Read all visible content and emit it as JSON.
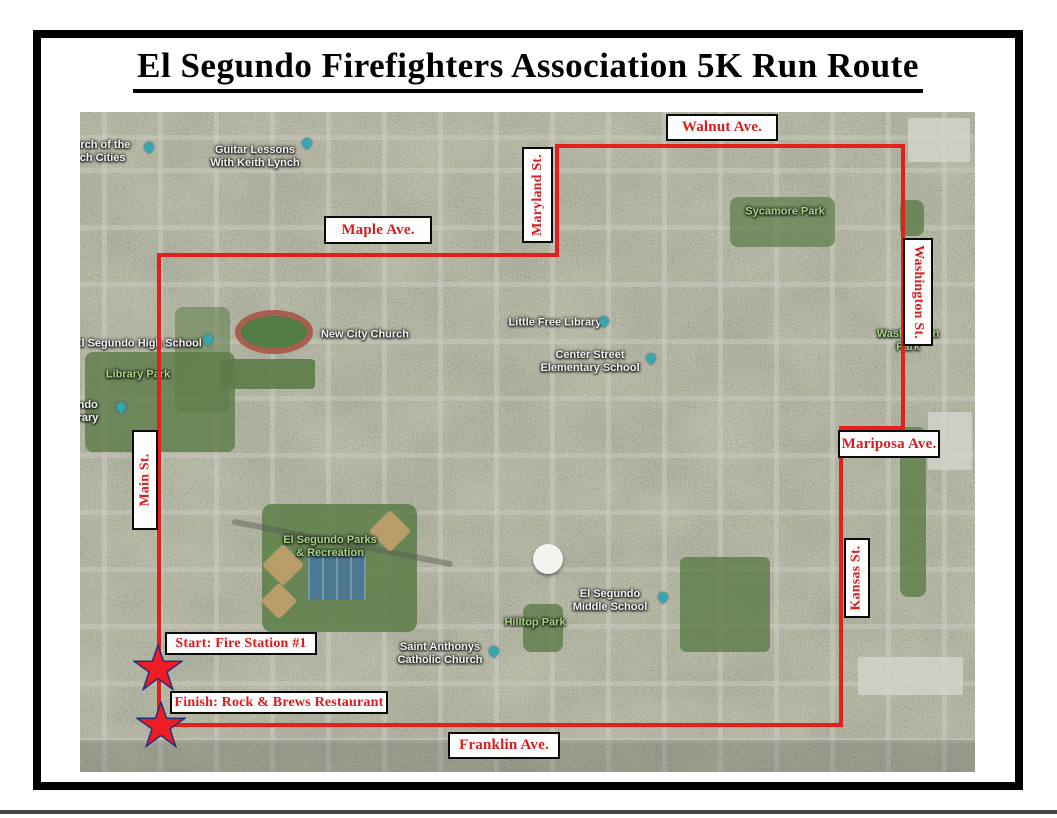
{
  "title": "El Segundo Firefighters Association 5K Run Route",
  "streets": {
    "walnut": "Walnut Ave.",
    "maple": "Maple Ave.",
    "maryland": "Maryland St.",
    "washington": "Washington St.",
    "mariposa": "Mariposa Ave.",
    "main": "Main St.",
    "kansas": "Kansas St.",
    "franklin": "Franklin Ave."
  },
  "markers": {
    "start": "Start: Fire Station #1",
    "finish": "Finish: Rock & Brews Restaurant"
  },
  "map_pois": {
    "church_beach_cities": {
      "line1": "urch of the",
      "line2": "ach Cities"
    },
    "guitar_lessons": {
      "line1": "Guitar Lessons",
      "line2": "With Keith Lynch"
    },
    "sycamore_park": "Sycamore Park",
    "high_school": "El Segundo High School",
    "library_park": "Library Park",
    "library_clipped": {
      "line1": "ndo",
      "line2": "rary"
    },
    "new_city_church": "New City Church",
    "little_free_library": "Little Free Library",
    "center_street_school": {
      "line1": "Center Street",
      "line2": "Elementary School"
    },
    "washington_park": {
      "line1": "Washington",
      "line2": "Park"
    },
    "parks_recreation": {
      "line1": "El Segundo Parks",
      "line2": "& Recreation"
    },
    "hilltop_park": "Hilltop Park",
    "middle_school": {
      "line1": "El Segundo",
      "line2": "Middle School"
    },
    "saint_anthonys": {
      "line1": "Saint Anthonys",
      "line2": "Catholic Church"
    }
  },
  "colors": {
    "route_red": "#e3201b",
    "label_red": "#d91d1f",
    "star_fill": "#ee1c25",
    "star_outline": "#24317a",
    "park_label_green": "#a6d483"
  }
}
